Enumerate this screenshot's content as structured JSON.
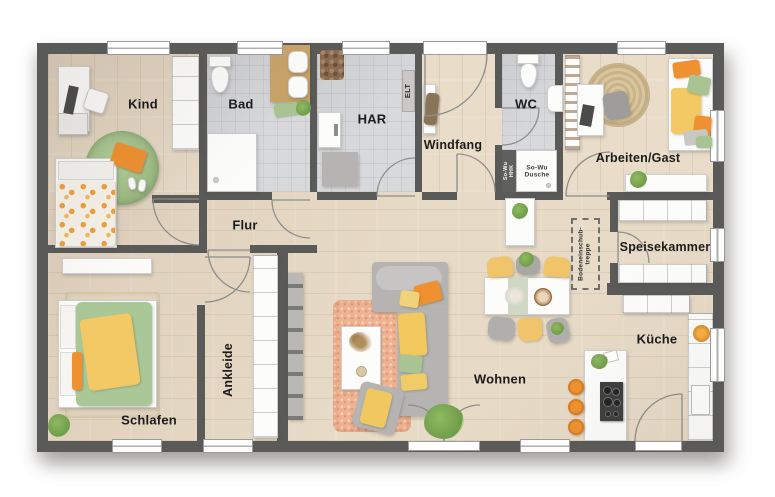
{
  "page": {
    "type": "floor-plan",
    "background": "#ffffff"
  },
  "palette": {
    "wall": "#5a5a59",
    "wood_floor": "#e8dbc8",
    "tile_floor": "#d8d9db",
    "accent_orange": "#ef9130",
    "accent_yellow": "#f2c964",
    "accent_green": "#a9c492",
    "rug_peach": "#efb392",
    "rug_jute": "#d5c29b",
    "furniture_white": "#fcfcfb",
    "furniture_gray": "#b5b4b2"
  },
  "room_labels": [
    {
      "id": "kind",
      "label": "Kind",
      "x": 143,
      "y": 105,
      "size": 13,
      "rotate": 0
    },
    {
      "id": "bad",
      "label": "Bad",
      "x": 241,
      "y": 105,
      "size": 13,
      "rotate": 0
    },
    {
      "id": "har",
      "label": "HAR",
      "x": 372,
      "y": 120,
      "size": 13,
      "rotate": 0
    },
    {
      "id": "windfang",
      "label": "Windfang",
      "x": 453,
      "y": 145,
      "size": 12.5,
      "rotate": 0
    },
    {
      "id": "wc",
      "label": "WC",
      "x": 526,
      "y": 105,
      "size": 13,
      "rotate": 0
    },
    {
      "id": "arbeiten-gast",
      "label": "Arbeiten/Gast",
      "x": 638,
      "y": 158,
      "size": 12.5,
      "rotate": 0
    },
    {
      "id": "flur",
      "label": "Flur",
      "x": 245,
      "y": 226,
      "size": 13,
      "rotate": 0
    },
    {
      "id": "speisekammer",
      "label": "Speisekammer",
      "x": 665,
      "y": 247,
      "size": 12.5,
      "rotate": 0
    },
    {
      "id": "ankleide",
      "label": "Ankleide",
      "x": 228,
      "y": 370,
      "size": 12.5,
      "rotate": -90
    },
    {
      "id": "schlafen",
      "label": "Schlafen",
      "x": 149,
      "y": 421,
      "size": 13,
      "rotate": 0
    },
    {
      "id": "wohnen",
      "label": "Wohnen",
      "x": 500,
      "y": 380,
      "size": 13,
      "rotate": 0
    },
    {
      "id": "kueche",
      "label": "Küche",
      "x": 657,
      "y": 340,
      "size": 13,
      "rotate": 0
    }
  ],
  "fixture_labels": [
    {
      "id": "elt",
      "label": "ELT",
      "x": 408,
      "y": 91,
      "size": 7.5,
      "rotate": -90,
      "color": "#2e2e2e"
    },
    {
      "id": "sowu-hhk",
      "label": "So-Wu\nHHK",
      "x": 509,
      "y": 171,
      "size": 5.5,
      "rotate": -90,
      "color": "#f4f4f2"
    },
    {
      "id": "sowu-dusche",
      "label": "So-Wu\nDusche",
      "x": 537,
      "y": 172,
      "size": 6.5,
      "rotate": 0,
      "color": "#3c3c3c"
    },
    {
      "id": "bodeneinschubtreppe",
      "label": "Bodeneinschub-\ntreppe",
      "x": 585,
      "y": 254,
      "size": 6.5,
      "rotate": -90,
      "color": "#2e2e2e"
    }
  ]
}
